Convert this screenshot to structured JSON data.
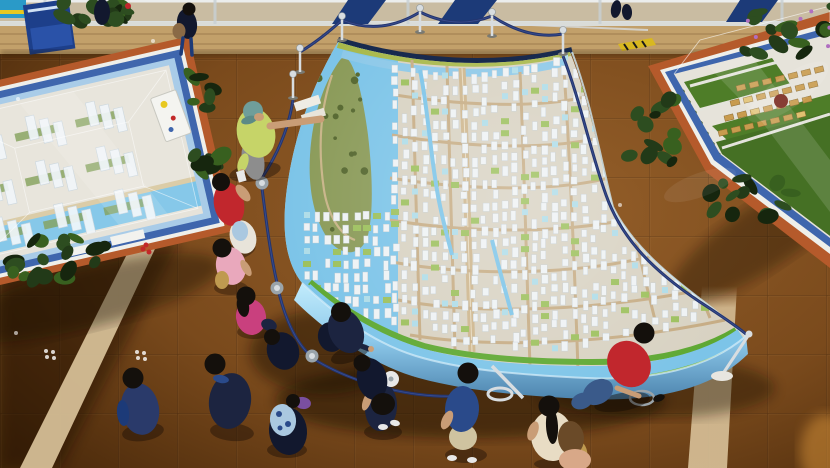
{
  "scene": {
    "type": "photograph-overhead",
    "setting": "mall-atrium-exhibition-hall",
    "subject": "visitors-viewing-large-architectural-town-scale-model",
    "people_count": 18,
    "stanchion_count": 9,
    "display_tables": 2
  },
  "palette": {
    "floorMid": "#8a5524",
    "floorEdge": "#46280e",
    "floorDark": "#2a1708",
    "beige": "#d9c29a",
    "wood": "#c2a06a",
    "woodDark": "#a8854f",
    "glass": "#cfd8da",
    "banner": "#1c3a78",
    "signBlue": "#1d3f8a",
    "posterCyan": "#2a9ac8",
    "posterYellow": "#e8c820",
    "ropeNavy": "#24356e",
    "ropeHi": "#3a4f92",
    "chrome": "#d8dde0",
    "chromeDark": "#9aa4aa",
    "modelBase": "#d8d2c2",
    "water": "#7cc4e8",
    "waterDeep": "#4f9cd0",
    "island": "#8a9a58",
    "islandDark": "#54662e",
    "trail": "#c8b488",
    "grass": "#79b53e",
    "bank": "#5ea832",
    "sand": "#d8c8a0",
    "road": "#c6ac84",
    "avenue": "#cdb58c",
    "bldg": "#eef2f4",
    "bldgGreen": "#9cc05c",
    "bldgCyan": "#aedce8",
    "sideFace1": "#aee0f6",
    "sideFace2": "#5e9cc8",
    "edgeNavy": "#182a4e",
    "topGreen": "#a8b84a",
    "tblOrange": "#b55a2b",
    "tblBlue": "#3f66ad",
    "tblLtBlue": "#a9cce8",
    "deck": "#e6e3da",
    "tower": "#f0f5fa",
    "lawn": "#4e7d28",
    "gold": "#c89b4e",
    "goldLight": "#e0c070",
    "treeDark": "#2d4a1c",
    "plant1": "#223a18",
    "plant2": "#2d4d20",
    "plant3": "#38601f",
    "plant4": "#16260e",
    "flowerPurple": "#b06fc0",
    "flowerRed": "#c22828",
    "pot": "#7a2a20",
    "skin": "#c99d76",
    "lime": "#c6d468",
    "teal": "#6f9e9a",
    "tealDark": "#5c8a86",
    "red": "#c1272d",
    "white": "#e8e4da",
    "pink": "#e9a8bc",
    "magenta": "#c9407e",
    "navyShirt": "#1c2440",
    "navyDark": "#12182e",
    "polo": "#2a4a8a",
    "khaki": "#cfc3a0",
    "denim": "#3a5a8a",
    "cream": "#e8dcc4",
    "tanBag": "#bf9a50",
    "hairDark": "#14100c",
    "capWhite": "#e8e8e8",
    "mauve": "#d8a888",
    "hairBrown": "#6a4a28",
    "bagBrown": "#8a6a46",
    "ltBlueBag": "#aac8e0",
    "purpleItem": "#7a4fa0",
    "jacketBlue": "#2a3a6a",
    "greyPants": "#8d8d8d",
    "shadow": "#140a04",
    "glow": "#e8a040"
  }
}
